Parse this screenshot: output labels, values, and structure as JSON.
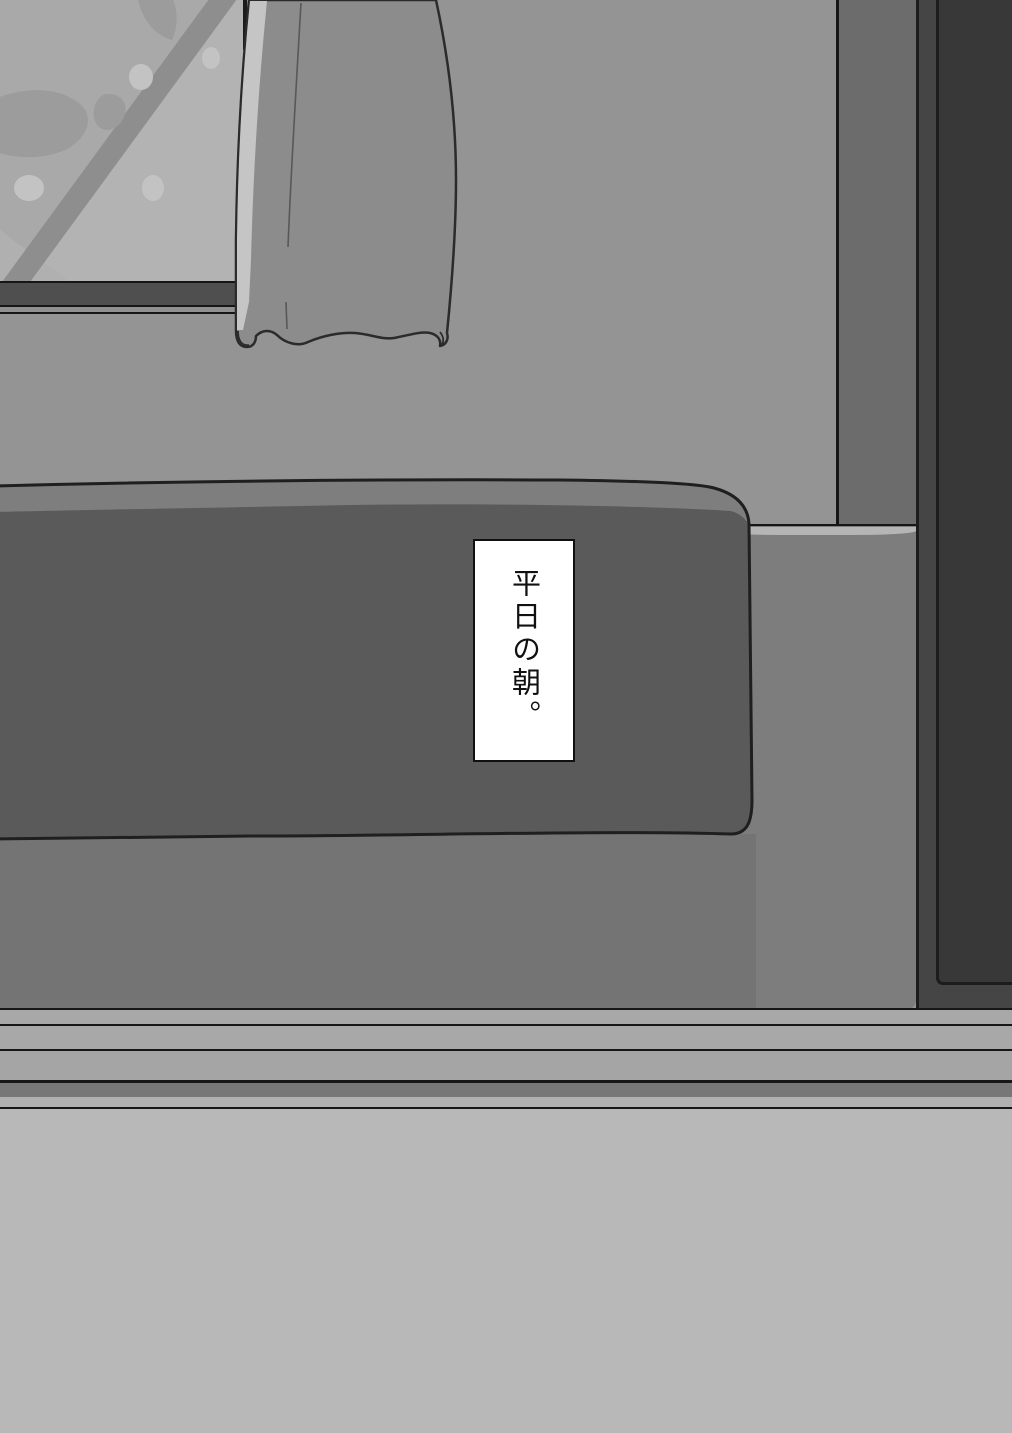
{
  "caption": {
    "text": "平日の朝。"
  },
  "colors": {
    "wall": "#949494",
    "wall_below_bed": "#747474",
    "glass": "#a9a9a9",
    "glass_light": "#b3b3b3",
    "glass_corner_light": "#b0b0b0",
    "glass_stripe": "#8e8e8e",
    "glass_shadow": "#9c9c9c",
    "glass_dot": "#c3c3c3",
    "sill_face": "#4f4f4f",
    "sill_rail": "#909090",
    "frame_line": "#1c1c1c",
    "line_dark": "#161616",
    "curtain_body": "#8c8c8c",
    "curtain_highlight": "#c5c5c5",
    "curtain_outline": "#2b2b2b",
    "curtain_fold": "#585858",
    "recess_band": "#6c6c6c",
    "ledge_face": "#7d7d7d",
    "ledge_top": "#b5b5b5",
    "door_frame": "#454545",
    "door_panel": "#383838",
    "bed_front": "#5a5a5a",
    "bed_top": "#7e7e7e",
    "bed_outline": "#1f1f1f",
    "baseboard_band": "#a8a8a8",
    "baseboard_band_mid": "#a5a5a5",
    "baseboard_dark": "#777777",
    "baseboard_light": "#b0b0b0",
    "floor": "#b8b8b8",
    "caption_bg": "#ffffff",
    "caption_border": "#101010",
    "caption_text": "#111111"
  }
}
